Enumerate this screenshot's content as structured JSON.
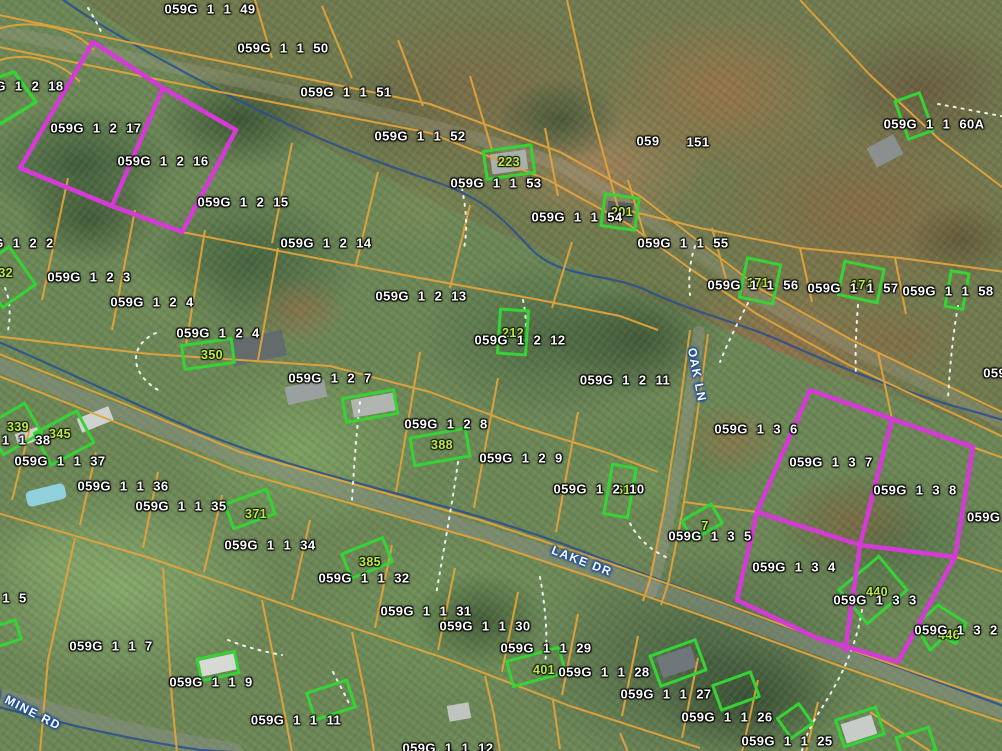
{
  "map": {
    "type_note": "county GIS parcel viewer over aerial imagery",
    "colors": {
      "parcel_line": "#e2a33c",
      "highlight_magenta": "#d63ad6",
      "building_green": "#35d435",
      "address_text": "#cfe050",
      "parcel_label_text": "#ffffff",
      "stream_blue": "#2a4f8f",
      "road_label_halo": "#1b4a9b",
      "driveway_dotted": "#ffffff"
    },
    "highlighted_parcels": [
      "059G 1 2 17",
      "059G 1 2 16",
      "059G 1 3 7",
      "059G 1 3 8",
      "059G 1 3 4",
      "059G 1 3 3"
    ],
    "green_outlined_parcel": "059G 1 2 18",
    "parcel_labels": [
      {
        "text": "059G 1 1 49",
        "x": 210,
        "y": 9
      },
      {
        "text": "059G 1 1 50",
        "x": 283,
        "y": 48
      },
      {
        "text": "059G 1 2 18",
        "x": 18,
        "y": 86
      },
      {
        "text": "059G 1 2 17",
        "x": 96,
        "y": 128
      },
      {
        "text": "059G 1 1 51",
        "x": 346,
        "y": 92
      },
      {
        "text": "059G 1 2 16",
        "x": 163,
        "y": 161
      },
      {
        "text": "059G 1 1 52",
        "x": 420,
        "y": 136
      },
      {
        "text": "059G 1 2 15",
        "x": 243,
        "y": 202
      },
      {
        "text": "059G 1 1 53",
        "x": 496,
        "y": 183
      },
      {
        "text": "059G 1 2 14",
        "x": 326,
        "y": 243
      },
      {
        "text": "059G 1 1 54",
        "x": 577,
        "y": 217
      },
      {
        "text": "059",
        "x": 648,
        "y": 141
      },
      {
        "text": "151",
        "x": 698,
        "y": 142
      },
      {
        "text": "059G 1 1 60A",
        "x": 934,
        "y": 124
      },
      {
        "text": "059G 1 1 55",
        "x": 683,
        "y": 243
      },
      {
        "text": "059G 1 2 2",
        "x": 12,
        "y": 243
      },
      {
        "text": "059G 1 2 3",
        "x": 89,
        "y": 277
      },
      {
        "text": "059G 1 1 56",
        "x": 753,
        "y": 285
      },
      {
        "text": "059G 1 1 57",
        "x": 853,
        "y": 288
      },
      {
        "text": "059G 1 1 58",
        "x": 948,
        "y": 291
      },
      {
        "text": "059G 1 2 4",
        "x": 152,
        "y": 302
      },
      {
        "text": "059G 1 2 13",
        "x": 421,
        "y": 296
      },
      {
        "text": "059G 1 2 4",
        "x": 218,
        "y": 333
      },
      {
        "text": "059G 1 2 12",
        "x": 520,
        "y": 340
      },
      {
        "text": "059G 1 2 7",
        "x": 330,
        "y": 378
      },
      {
        "text": "059G 1 2 11",
        "x": 625,
        "y": 380
      },
      {
        "text": "059G",
        "x": 1000,
        "y": 373
      },
      {
        "text": "059G 1 3 6",
        "x": 756,
        "y": 429
      },
      {
        "text": "059G 1 2 8",
        "x": 446,
        "y": 424
      },
      {
        "text": "059G 1 2 9",
        "x": 521,
        "y": 458
      },
      {
        "text": "059G 1 2 10",
        "x": 599,
        "y": 489
      },
      {
        "text": "059G 1 3 7",
        "x": 831,
        "y": 462
      },
      {
        "text": "059G 1 3 8",
        "x": 915,
        "y": 490
      },
      {
        "text": "059G 1",
        "x": 992,
        "y": 517
      },
      {
        "text": "059G 1 1 38",
        "x": 5,
        "y": 440
      },
      {
        "text": "059G 1 1 37",
        "x": 60,
        "y": 461
      },
      {
        "text": "059G 1 1 36",
        "x": 123,
        "y": 486
      },
      {
        "text": "059G 1 1 35",
        "x": 181,
        "y": 506
      },
      {
        "text": "059G 1 1 34",
        "x": 270,
        "y": 545
      },
      {
        "text": "059G 1 1 32",
        "x": 364,
        "y": 578
      },
      {
        "text": "059G 1 1 31",
        "x": 426,
        "y": 611
      },
      {
        "text": "059G 1 3 5",
        "x": 710,
        "y": 536
      },
      {
        "text": "059G 1 3 4",
        "x": 794,
        "y": 567
      },
      {
        "text": "059G 1 3 3",
        "x": 875,
        "y": 600
      },
      {
        "text": "059G 1 3 2",
        "x": 956,
        "y": 630
      },
      {
        "text": "059G 1 1 5",
        "x": -15,
        "y": 598
      },
      {
        "text": "059G 1 1 7",
        "x": 111,
        "y": 646
      },
      {
        "text": "059G 1 1 30",
        "x": 485,
        "y": 626
      },
      {
        "text": "059G 1 1 29",
        "x": 546,
        "y": 648
      },
      {
        "text": "059G 1 1 28",
        "x": 604,
        "y": 672
      },
      {
        "text": "059G 1 1 27",
        "x": 666,
        "y": 694
      },
      {
        "text": "059G 1 1 26",
        "x": 727,
        "y": 717
      },
      {
        "text": "059G 1 1 25",
        "x": 787,
        "y": 741
      },
      {
        "text": "059G 1 1 9",
        "x": 211,
        "y": 682
      },
      {
        "text": "059G 1 1 11",
        "x": 296,
        "y": 720
      },
      {
        "text": "059G 1 1 12",
        "x": 448,
        "y": 748
      }
    ],
    "address_labels": [
      {
        "text": "223",
        "x": 509,
        "y": 162
      },
      {
        "text": "201",
        "x": 622,
        "y": 212
      },
      {
        "text": "171",
        "x": 758,
        "y": 283
      },
      {
        "text": "174",
        "x": 862,
        "y": 285
      },
      {
        "text": "350",
        "x": 212,
        "y": 355
      },
      {
        "text": "212",
        "x": 513,
        "y": 333
      },
      {
        "text": "332",
        "x": 2,
        "y": 273
      },
      {
        "text": "339",
        "x": 18,
        "y": 427
      },
      {
        "text": "345",
        "x": 60,
        "y": 434
      },
      {
        "text": "388",
        "x": 442,
        "y": 445
      },
      {
        "text": "371",
        "x": 256,
        "y": 514
      },
      {
        "text": "385",
        "x": 370,
        "y": 562
      },
      {
        "text": "401",
        "x": 544,
        "y": 670
      },
      {
        "text": "440",
        "x": 877,
        "y": 592
      },
      {
        "text": "446",
        "x": 949,
        "y": 635
      },
      {
        "text": "610",
        "x": 627,
        "y": 490
      },
      {
        "text": "7",
        "x": 705,
        "y": 526
      }
    ],
    "road_labels": [
      {
        "text": "LAKE DR",
        "x": 582,
        "y": 561,
        "rot": 21
      },
      {
        "text": "OAK LN",
        "x": 697,
        "y": 375,
        "rot": 79
      },
      {
        "text": "CA MINE RD",
        "x": 22,
        "y": 707,
        "rot": 27
      }
    ]
  }
}
